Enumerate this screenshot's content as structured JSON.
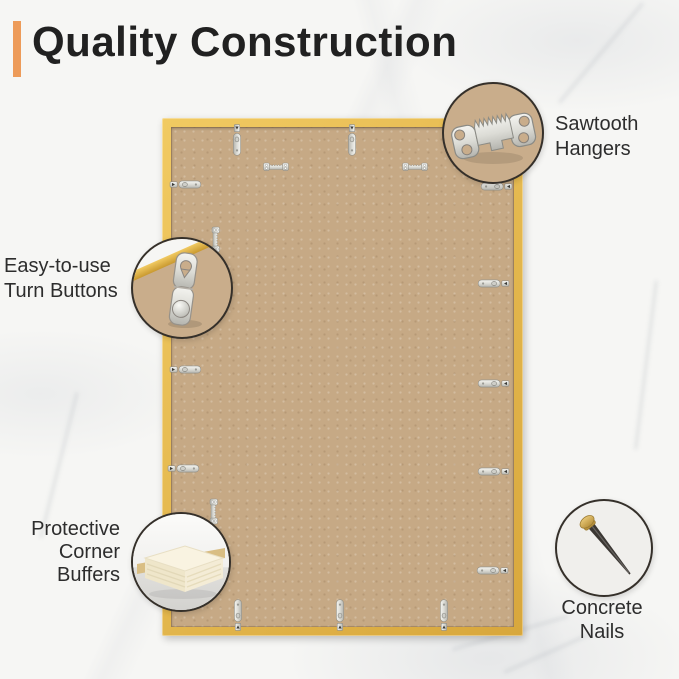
{
  "title": {
    "text": "Quality Construction"
  },
  "callouts": {
    "sawtooth_hangers": {
      "label": "Sawtooth\nHangers",
      "icon": "sawtooth-hanger-icon"
    },
    "turn_buttons": {
      "label": "Easy-to-use\nTurn Buttons",
      "icon": "turn-button-icon"
    },
    "corner_buffers": {
      "label": "Protective\nCorner\nBuffers",
      "icon": "corner-buffer-icon"
    },
    "concrete_nails": {
      "label": "Concrete\nNails",
      "icon": "concrete-nail-icon"
    }
  },
  "colors": {
    "accent": "#ED9B59",
    "title_text": "#212121",
    "label_text": "#2D2D2D",
    "frame_gold_light": "#F1CA62",
    "frame_gold_dark": "#D8A73C",
    "backing": "#C6A985",
    "callout_tan": "#C9AD8B",
    "circle_border": "#35302A",
    "metal": "#DCDCD6",
    "foam_cream": "#F4ECD6",
    "nail_shaft": "#3B3733",
    "nail_head": "#C9A24A",
    "background": "#F6F6F4"
  }
}
